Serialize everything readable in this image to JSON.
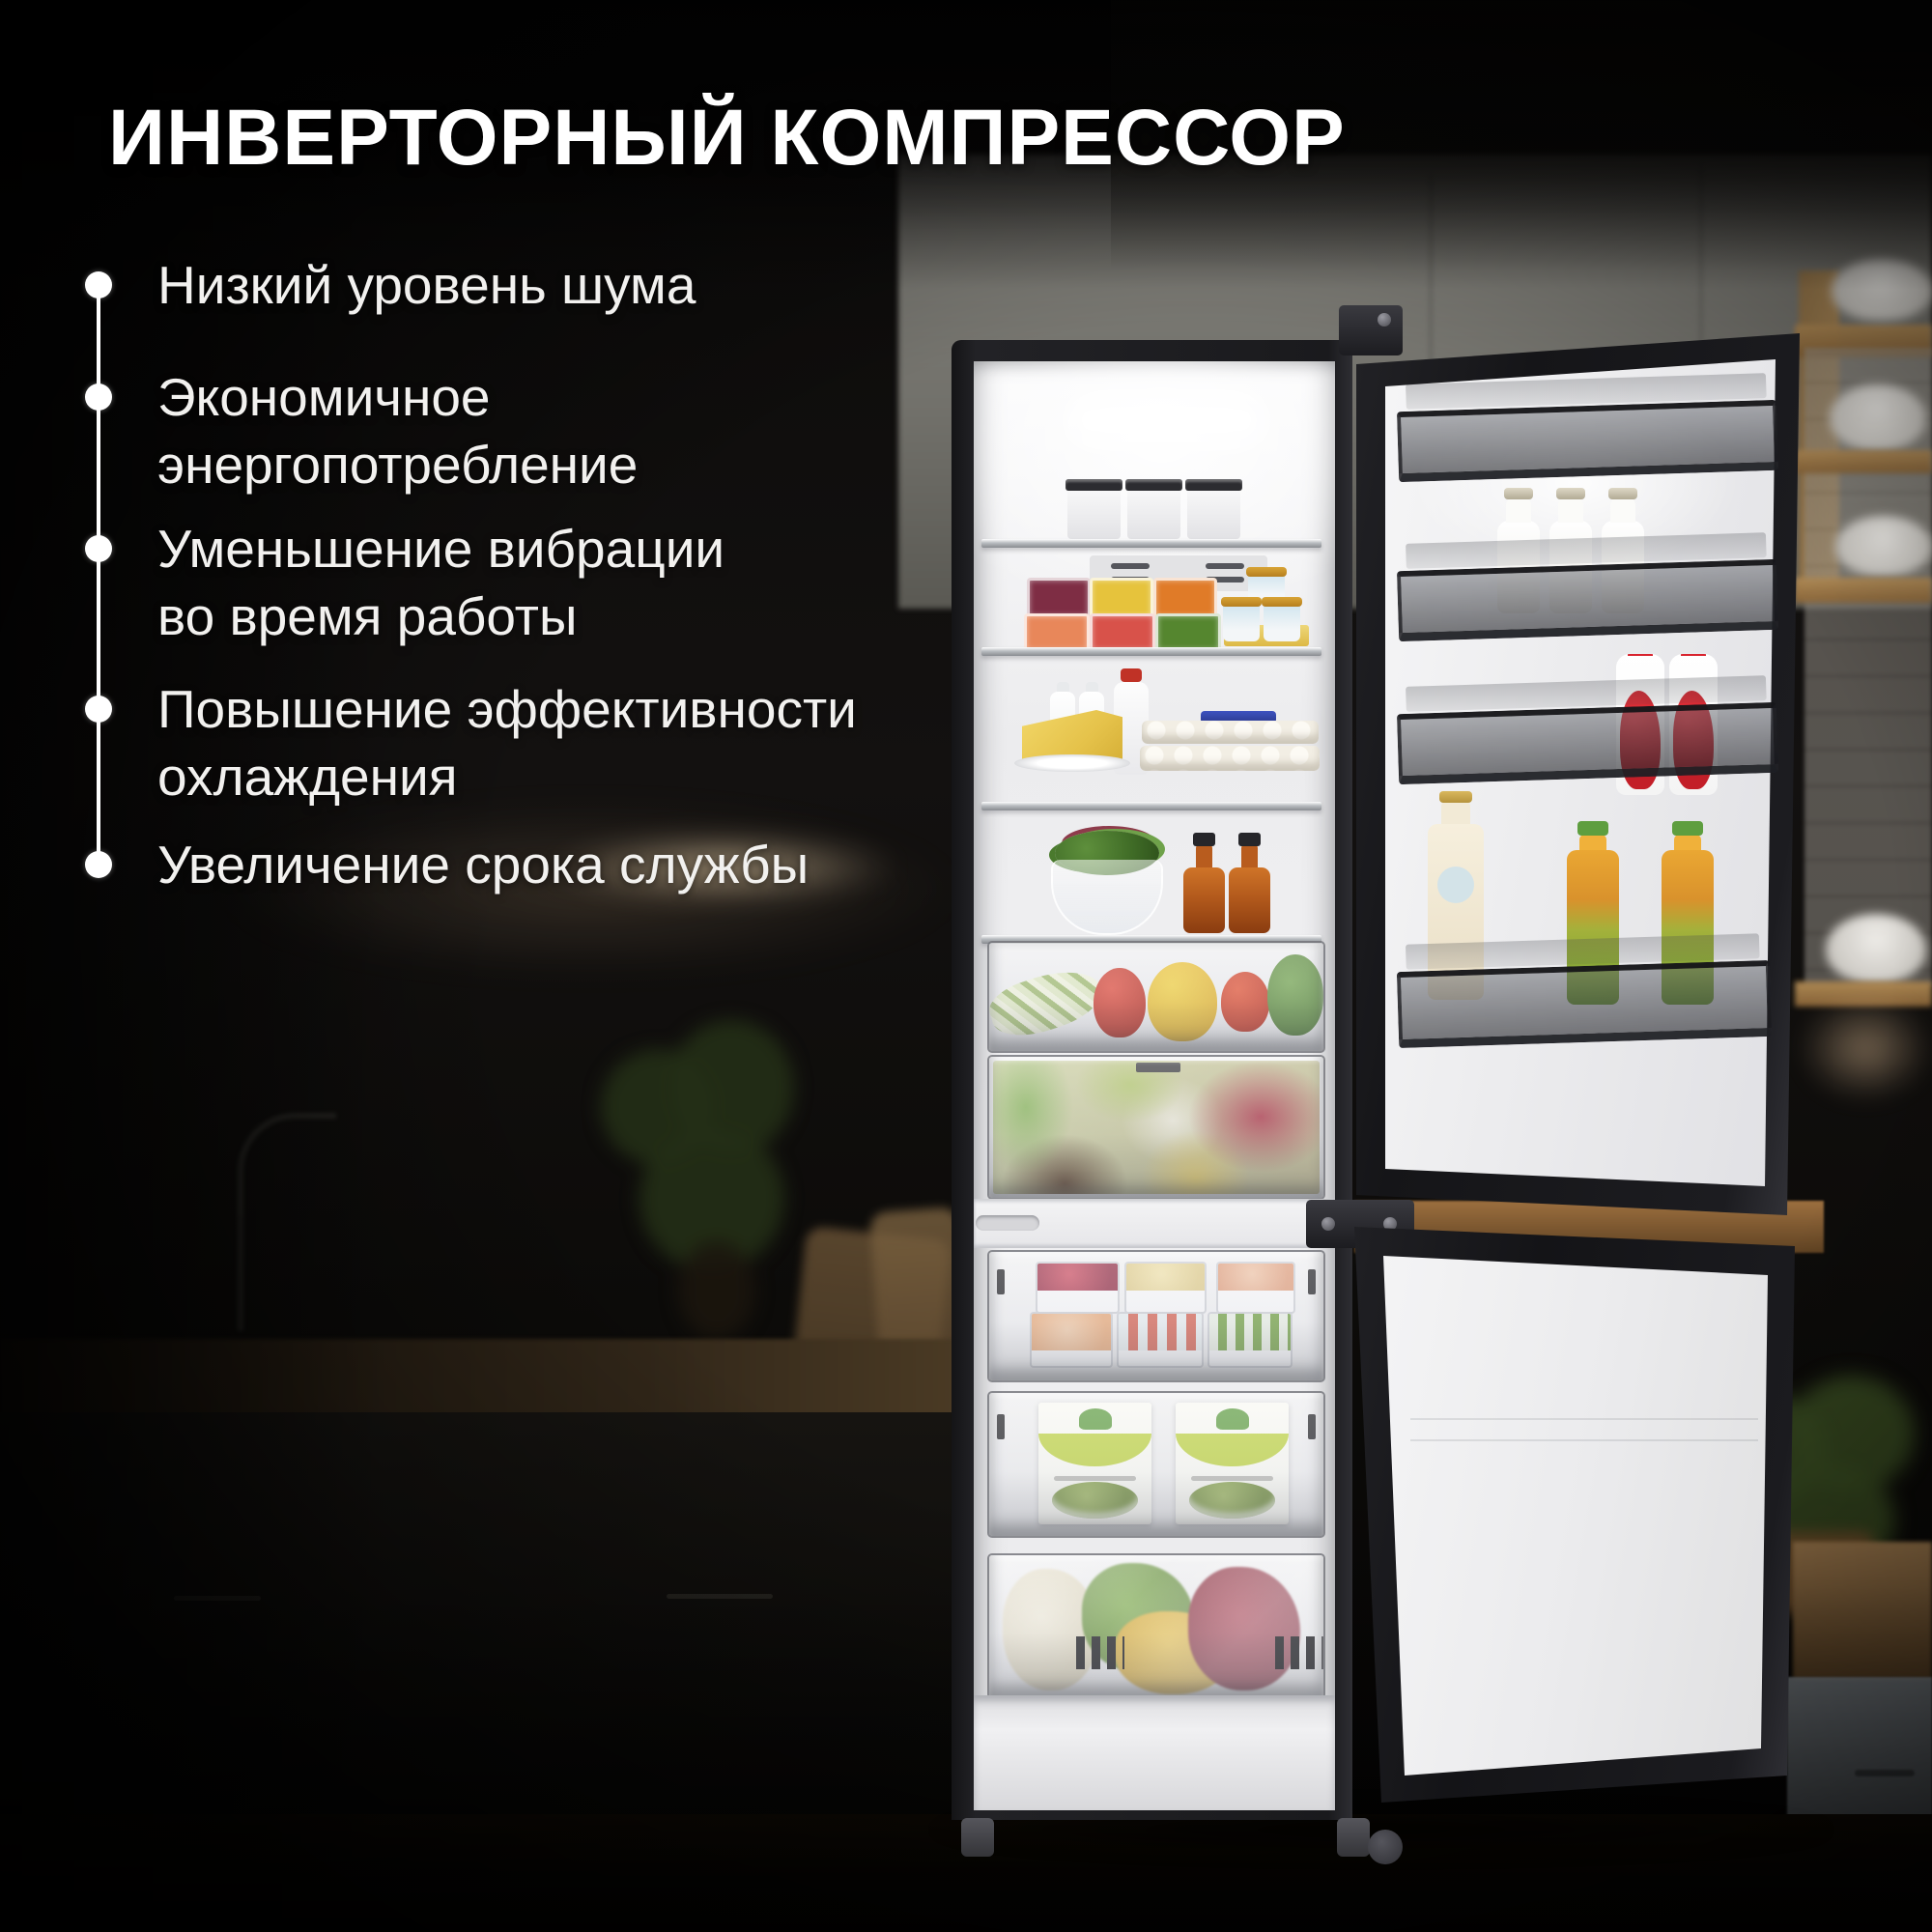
{
  "title": "ИНВЕРТОРНЫЙ КОМПРЕССОР",
  "features": [
    {
      "line1": "Низкий уровень шума",
      "line2": ""
    },
    {
      "line1": "Экономичное",
      "line2": "энергопотребление"
    },
    {
      "line1": "Уменьшение вибрации",
      "line2": "во время работы"
    },
    {
      "line1": "Повышение эффективности",
      "line2": "охлаждения"
    },
    {
      "line1": "Увеличение срока службы",
      "line2": ""
    }
  ],
  "colors": {
    "background": "#0b0a09",
    "title_text": "#ffffff",
    "feature_text": "#f2f1ef",
    "bullet": "#ffffff",
    "fridge_frame": "#1a1a1d",
    "fridge_interior": "#f2f2f3",
    "warm_glow": "#ffdfae"
  }
}
